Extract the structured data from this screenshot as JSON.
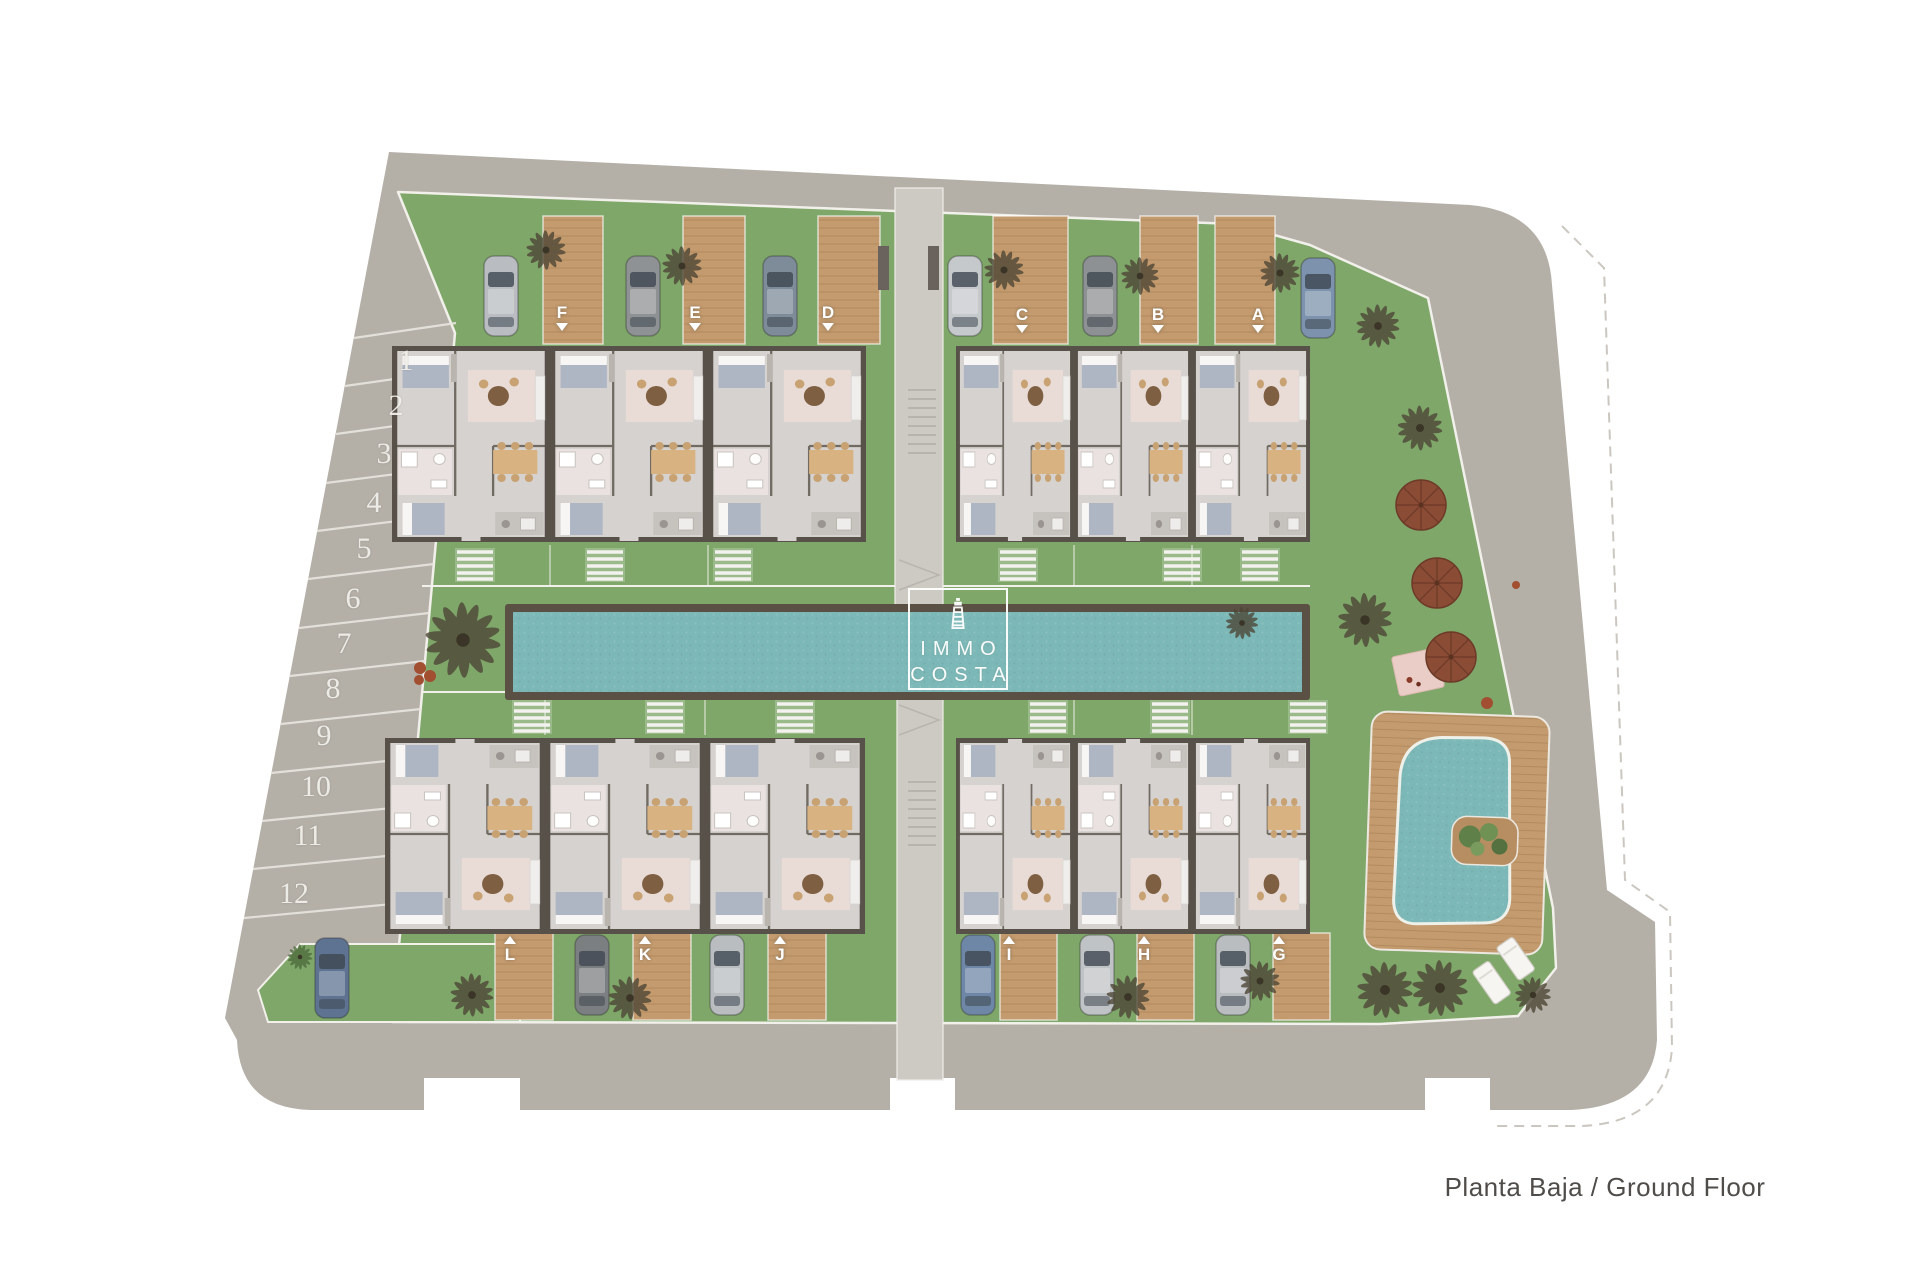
{
  "caption": "Planta Baja / Ground Floor",
  "logo": {
    "line1": "IMMO",
    "line2": "COSTA",
    "icon": "lighthouse"
  },
  "unit_labels": {
    "top": [
      "F",
      "E",
      "D",
      "C",
      "B",
      "A"
    ],
    "bottom": [
      "L",
      "K",
      "J",
      "I",
      "H",
      "G"
    ]
  },
  "parking_spaces": [
    "1",
    "2",
    "3",
    "4",
    "5",
    "6",
    "7",
    "8",
    "9",
    "10",
    "11",
    "12"
  ],
  "colors": {
    "road": "#b4afa7",
    "grass": "#7fa76a",
    "water": "#7cb8b7",
    "wood": "#c49b6e",
    "pool_frame": "#5b5044",
    "wall": "#585149",
    "floor": "#d6d2cf",
    "walkway": "#cdcac4",
    "parasol": "#8a4c35",
    "label": "#ffffff",
    "caption_text": "#4f4c49"
  }
}
